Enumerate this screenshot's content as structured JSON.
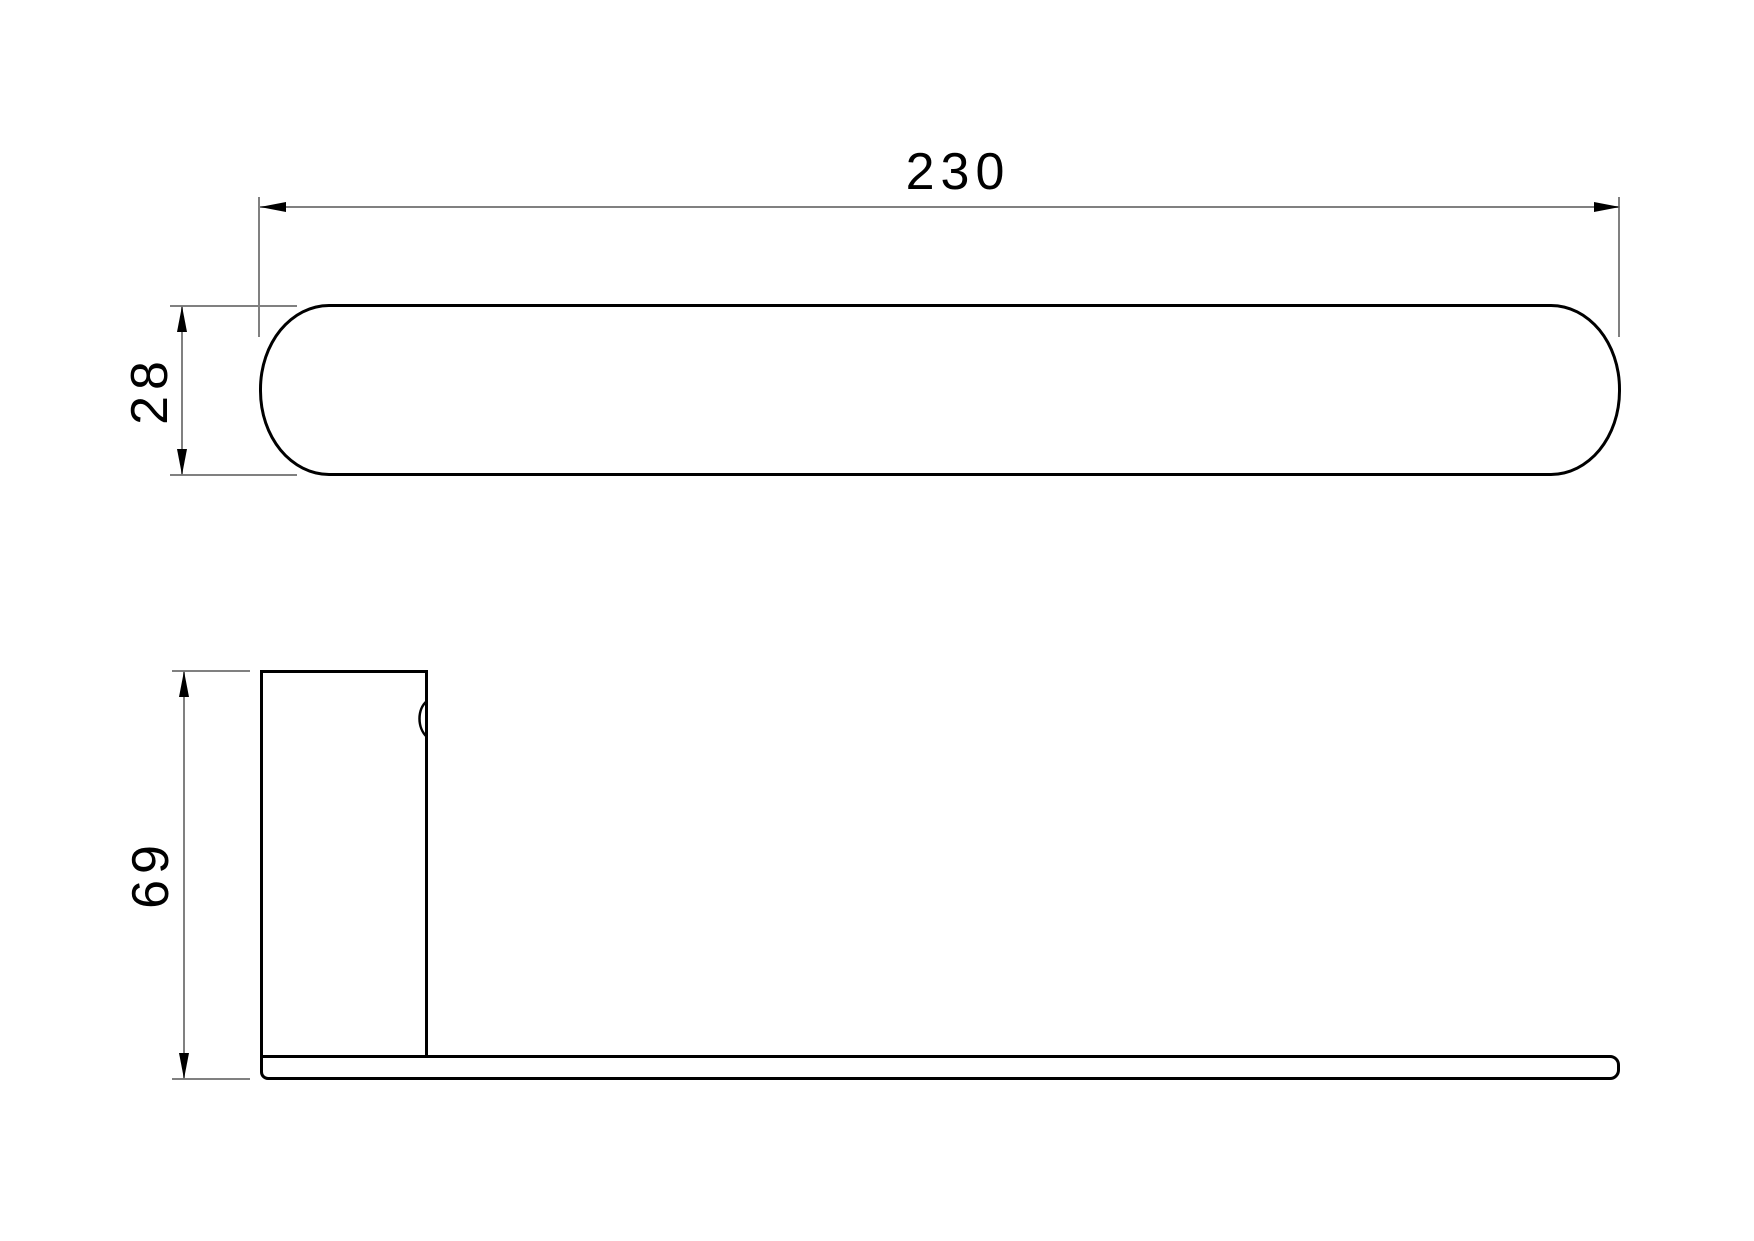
{
  "drawing": {
    "colors": {
      "outline": "#000000",
      "dimension_lines": "#808080",
      "arrowheads": "#000000",
      "text": "#000000",
      "background": "#ffffff"
    },
    "views": {
      "top": {
        "width_label": "230",
        "height_label": "28"
      },
      "side": {
        "height_label": "69"
      }
    }
  }
}
